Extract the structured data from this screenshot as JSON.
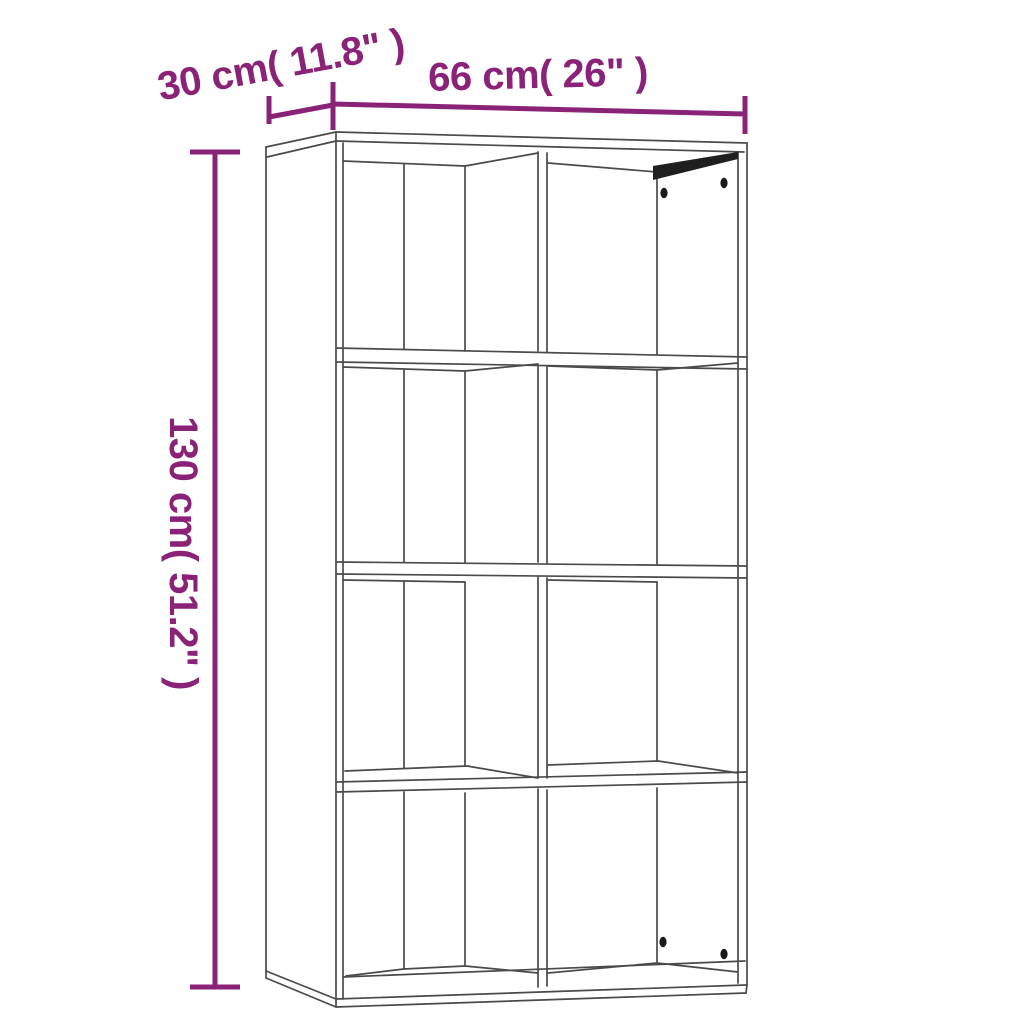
{
  "labels": {
    "depth": "30 cm( 11.8\" )",
    "width": "66 cm( 26\" )",
    "height": "130 cm( 51.2\" )"
  },
  "figure": {
    "description": "8-cube bookcase line drawing, front-left perspective",
    "rows": 4,
    "columns": 2,
    "peg_holes_top_right_cell": 2,
    "peg_holes_bottom_right_cell": 2
  },
  "colors": {
    "accent": "#8A2277",
    "lineart": "#4A4A4A",
    "shadow": "#1F1F1F",
    "bg": "#FFFFFF"
  }
}
